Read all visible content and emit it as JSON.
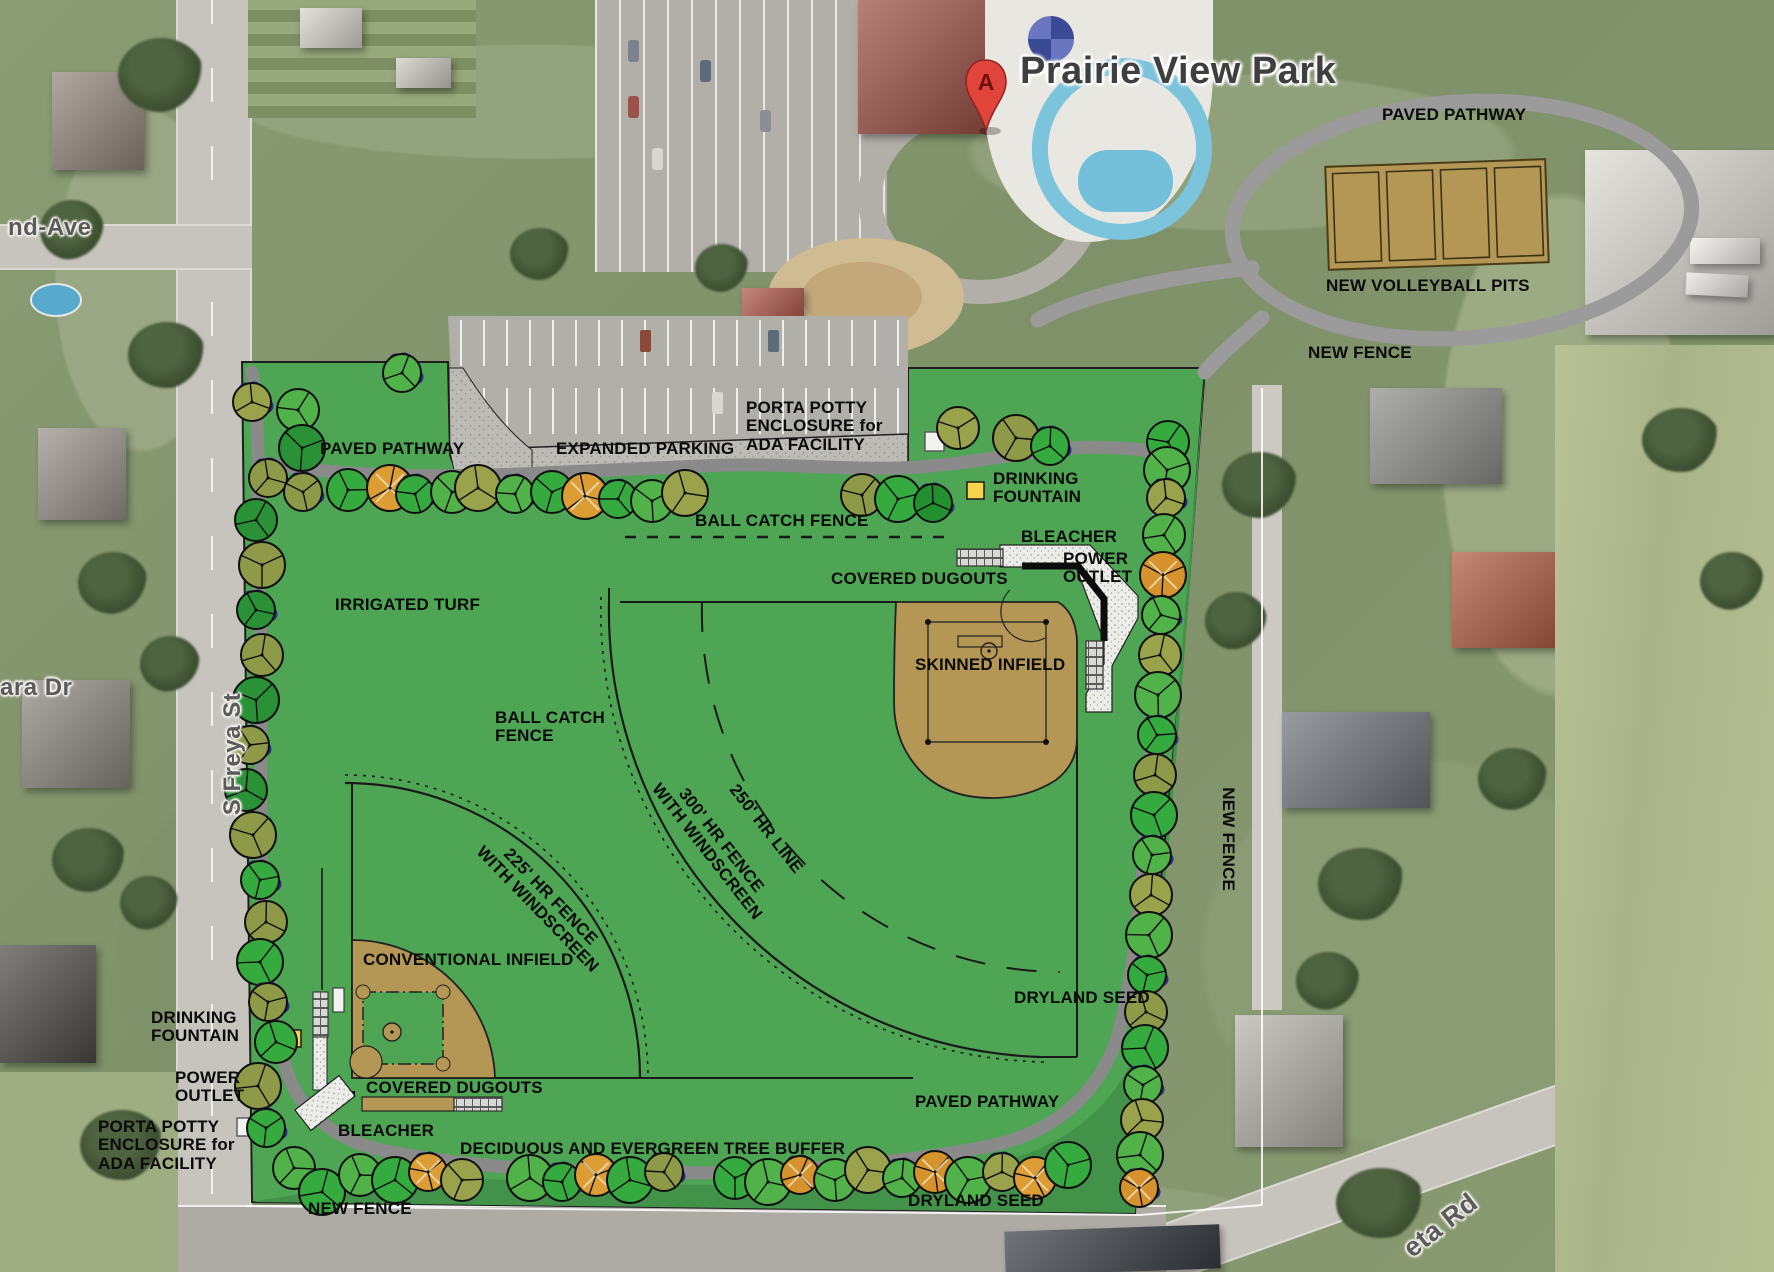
{
  "title": "Prairie View Park",
  "marker": {
    "letter": "A"
  },
  "streets": {
    "ave": "nd-Ave",
    "dr": "ara Dr",
    "freya": "S Freya St",
    "rd": "eta Rd"
  },
  "labels": {
    "paved_pathway_ne": "PAVED PATHWAY",
    "new_volleyball_pits": "NEW VOLLEYBALL PITS",
    "new_fence_ne": "NEW FENCE",
    "porta_potty_n": "PORTA POTTY\nENCLOSURE for\nADA FACILITY",
    "expanded_parking": "EXPANDED PARKING",
    "paved_pathway_nw": "PAVED PATHWAY",
    "drinking_fountain_n": "DRINKING\nFOUNTAIN",
    "ball_catch_fence_n": "BALL CATCH FENCE",
    "bleacher_ne": "BLEACHER",
    "power_outlet_ne": "POWER\nOUTLET",
    "covered_dugouts_ne": "COVERED DUGOUTS",
    "skinned_infield": "SKINNED INFIELD",
    "irrigated_turf": "IRRIGATED TURF",
    "ball_catch_fence_w": "BALL CATCH\nFENCE",
    "hr_line_250": "250' HR LINE",
    "hr_fence_300": "300' HR FENCE\nWITH WINDSCREEN",
    "hr_fence_225": "225' HR FENCE\nWITH WINDSCREEN",
    "conventional_infield": "CONVENTIONAL INFIELD",
    "dryland_seed_e": "DRYLAND SEED",
    "new_fence_e": "NEW FENCE",
    "drinking_fountain_sw": "DRINKING\nFOUNTAIN",
    "power_outlet_sw": "POWER\nOUTLET",
    "porta_potty_sw": "PORTA POTTY\nENCLOSURE for\nADA FACILITY",
    "bleacher_sw": "BLEACHER",
    "covered_dugouts_sw": "COVERED DUGOUTS",
    "tree_buffer": "DECIDUOUS AND EVERGREEN TREE BUFFER",
    "paved_pathway_s": "PAVED PATHWAY",
    "dryland_seed_s": "DRYLAND SEED",
    "new_fence_s": "NEW FENCE"
  },
  "colors": {
    "site_green": "#4ea654",
    "dryland_green": "#42924a",
    "infield_tan": "#b49655",
    "path_gray": "#8a8a8a",
    "fountain_yellow": "#f6d44c",
    "tree_shadow_blue": "#28317c",
    "marker_red": "#e0443a"
  }
}
